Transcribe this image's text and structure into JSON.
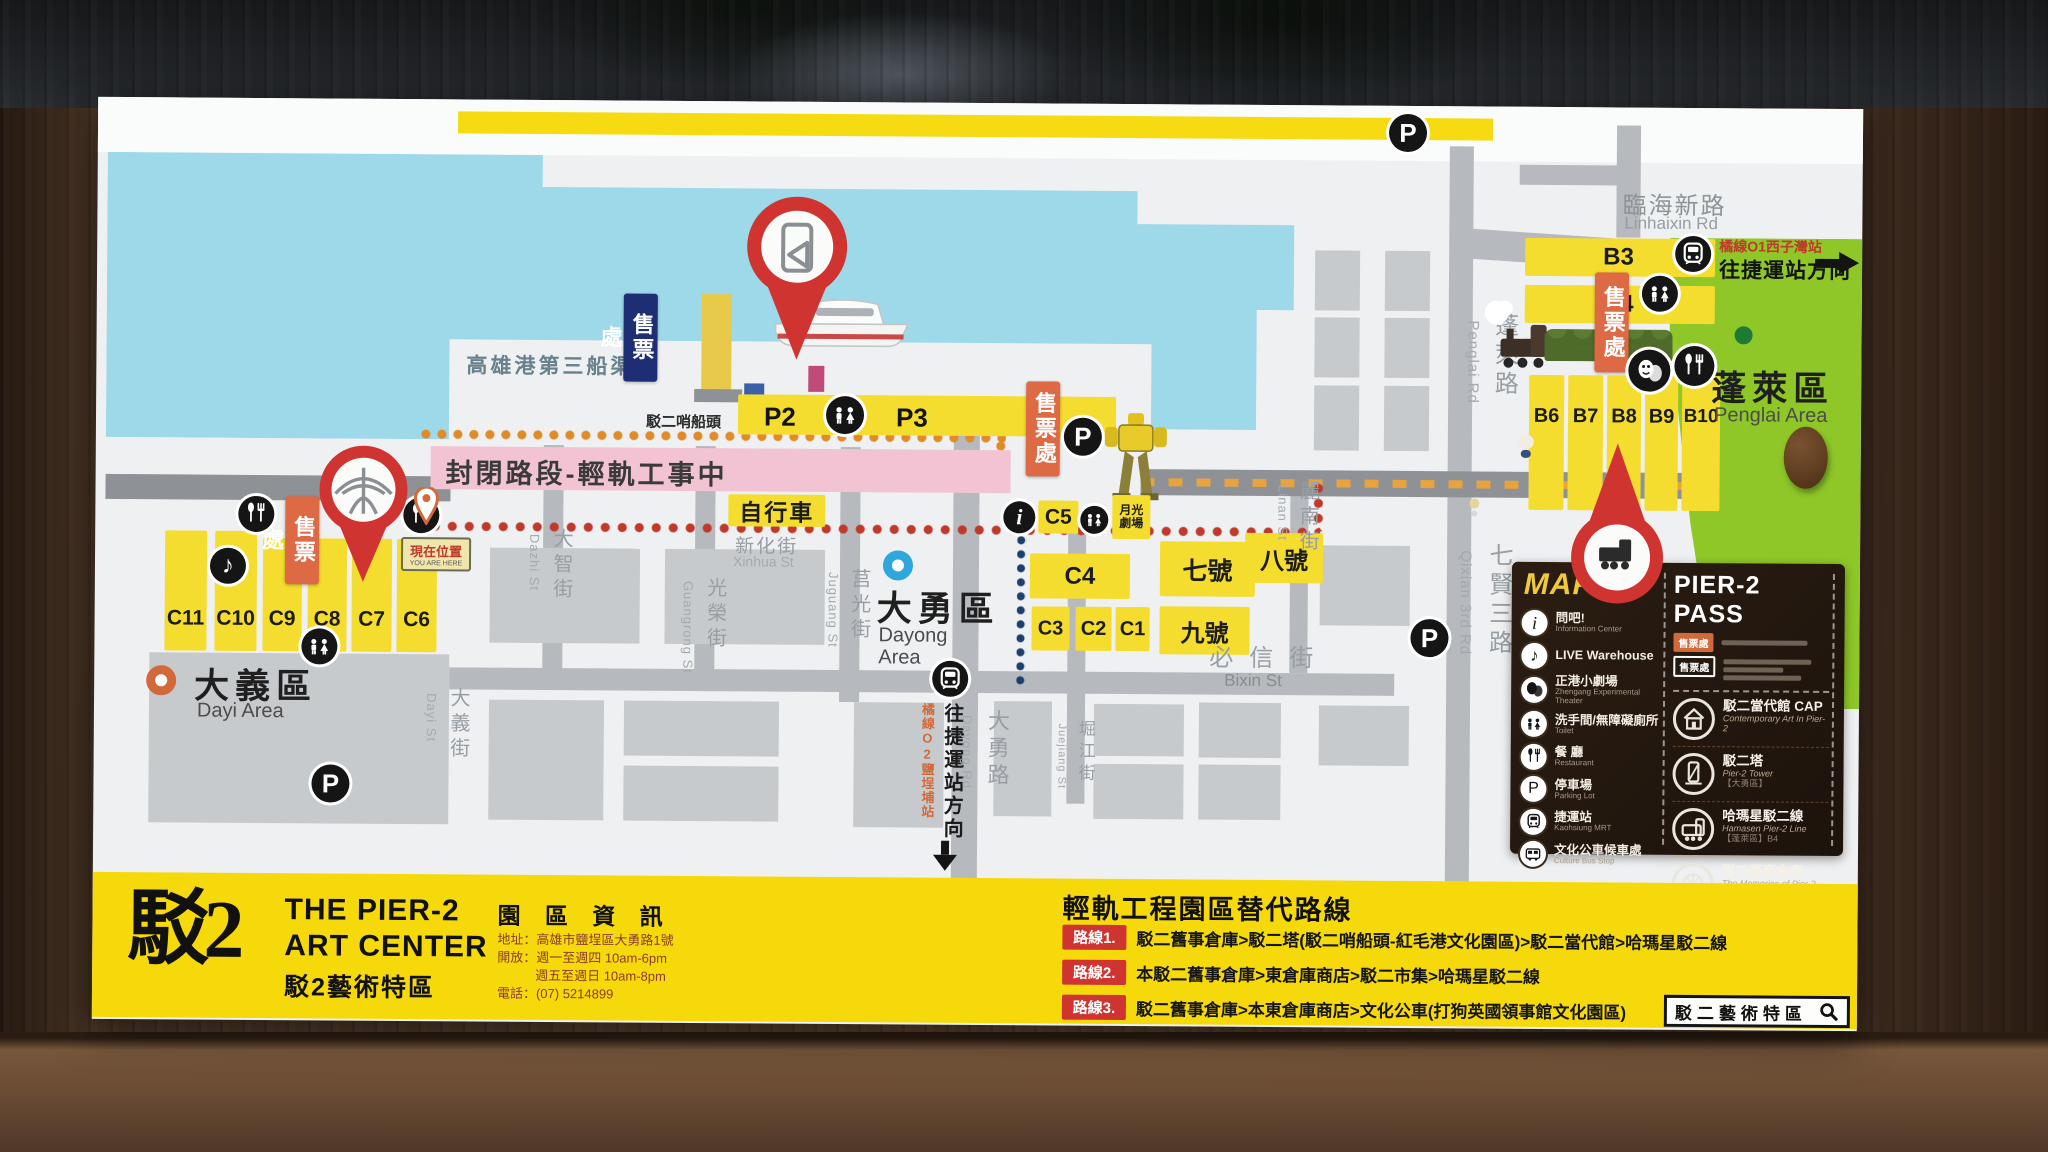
{
  "map": {
    "water_label": "高雄港第三船渠",
    "pier_label": "駁二哨船頭",
    "ticket": "售票處",
    "closed_road": "封閉路段-輕軌工事中",
    "bicycle": "自行車",
    "you_are_here_zh": "現在位置",
    "you_are_here_en": "YOU ARE HERE",
    "moonlight": "月光劇場",
    "mrt_dir": "往捷運站方向",
    "mrt_o1": "橘線O1西子灣站",
    "mrt_o2": "橘線O2鹽埕埔站",
    "areas": {
      "dayi_zh": "大義區",
      "dayi_en": "Dayi Area",
      "dayong_zh": "大勇區",
      "dayong_en1": "Dayong",
      "dayong_en2": "Area",
      "penglai_zh": "蓬萊區",
      "penglai_en": "Penglai Area"
    },
    "streets": {
      "linhaixin_zh": "臨海新路",
      "linhaixin_en": "Linhaixin Rd",
      "penglai_zh": "蓬萊路",
      "penglai_en": "Penglai Rd",
      "qixian_zh": "七賢三路",
      "qixian_en": "Qixian 3rd Rd",
      "linan_zh": "麗南街",
      "linan_en": "Linan St",
      "dayi_zh": "大義街",
      "dayi_en": "Dayi St",
      "dazhi_zh": "大智街",
      "dazhi_en": "Dazhi St",
      "guangrong_zh": "光榮街",
      "guangrong_en": "Guangrong St",
      "xinhua_zh": "新化街",
      "xinhua_en": "Xinhua St",
      "juguang_zh": "莒光街",
      "juguang_en": "Juguang St",
      "dayong_zh": "大勇路",
      "dayong_en": "Dayong Rd",
      "juejiang_zh": "堀江街",
      "juejiang_en": "Juejiang St",
      "bixin_zh": "必信街",
      "bixin_en": "Bixin St"
    },
    "blocks": {
      "c_left": [
        "C11",
        "C10",
        "C9",
        "C8",
        "C7",
        "C6"
      ],
      "c5": "C5",
      "c4": "C4",
      "c_small": [
        "C3",
        "C2",
        "C1"
      ],
      "no7": "七號",
      "no8": "八號",
      "no9": "九號",
      "p2": "P2",
      "p3": "P3",
      "b3": "B3",
      "b4": "B4",
      "b_row": [
        "B6",
        "B7",
        "B8",
        "B9",
        "B10"
      ]
    }
  },
  "legend": {
    "title": "MAP",
    "items": [
      {
        "zh": "問吧!",
        "en": "Information Center"
      },
      {
        "zh": "LIVE Warehouse",
        "en": ""
      },
      {
        "zh": "正港小劇場",
        "en": "Zhengang Experimental Theater"
      },
      {
        "zh": "洗手間/無障礙廁所",
        "en": "Toilet"
      },
      {
        "zh": "餐 廳",
        "en": "Restaurant"
      },
      {
        "zh": "停車場",
        "en": "Parking Lot"
      },
      {
        "zh": "捷運站",
        "en": "Kaohsiung MRT"
      },
      {
        "zh": "文化公車候車處",
        "en": "Culture Bus Stop"
      }
    ]
  },
  "pass": {
    "title": "PIER-2 PASS",
    "ticket": "售票處",
    "items": [
      {
        "zh": "駁二當代館 CAP",
        "en": "Contemporary Art In Pier-2",
        "note": ""
      },
      {
        "zh": "駁二塔",
        "en": "Pier-2 Tower",
        "note": "【大勇區】"
      },
      {
        "zh": "哈瑪星駁二線",
        "en": "Hamasen Pier-2 Line",
        "note": "【蓬萊區】B4"
      },
      {
        "zh": "駁二舊事倉庫",
        "en": "The Memories of Pier-2 Warehouse",
        "note": "【大義區】C7"
      }
    ]
  },
  "footer": {
    "logo_zh": "駁",
    "logo_num": "2",
    "title1": "THE PIER-2",
    "title2": "ART CENTER",
    "title_zh": "駁2藝術特區",
    "info_title": "園 區 資 訊",
    "info_l1": "地址：高雄市鹽埕區大勇路1號",
    "info_l2": "開放：週一至週四 10am-6pm",
    "info_l3": "週五至週日 10am-8pm",
    "info_l4": "電話：(07) 5214899",
    "routes_title": "輕軌工程園區替代路線",
    "routes": [
      {
        "badge": "路線1.",
        "text": "駁二舊事倉庫>駁二塔(駁二哨船頭-紅毛港文化園區)>駁二當代館>哈瑪星駁二線"
      },
      {
        "badge": "路線2.",
        "text": "本駁二舊事倉庫>東倉庫商店>駁二市集>哈瑪星駁二線"
      },
      {
        "badge": "路線3.",
        "text": "駁二舊事倉庫>本東倉庫商店>文化公車(打狗英國領事館文化園區)"
      }
    ],
    "search": "駁二藝術特區"
  }
}
